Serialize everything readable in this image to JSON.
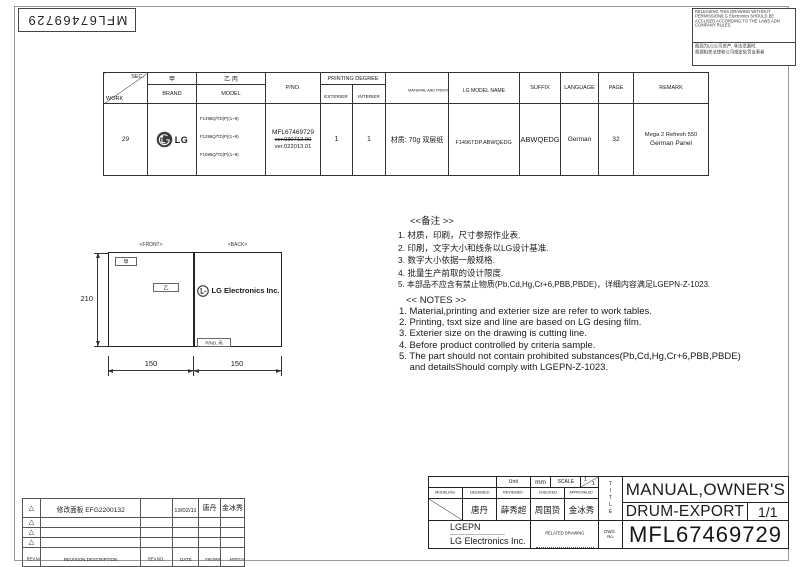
{
  "frame": {
    "code_label": "MFL67469729"
  },
  "notice": {
    "en": "RELEASING THIS DRAWING WITHOUT PERMISSION(LG Electronics SHOULD BE ACCUSED ACCORDING TO THE LAWS ADN COMPANY RULES.",
    "cn1": "图面为LG公司资产, 非法泄漏时,",
    "cn2": "根据相关法律和公司规定处罚当事者"
  },
  "work_table": {
    "h_sec": "SEC.",
    "h_work": "WORK",
    "h_jia": "甲",
    "h_brand": "BRAND",
    "h_yibing": "乙 丙",
    "h_model": "MODEL",
    "h_pno": "P/NO.",
    "h_printing_degree": "PRINTING DEGREE",
    "h_exterier": "EXTERIER",
    "h_interier": "INTERIER",
    "h_material": "MATERIAL AND PRINTING DESCRIPTION",
    "h_lg_model": "LG MODEL NAME",
    "h_suffix": "SUFFIX",
    "h_language": "LANGUAGE",
    "h_page": "PAGE",
    "h_remark": "REMARK",
    "work": "29",
    "brand": "LG",
    "models": [
      "F1496Q/TD(P)(1~9)",
      "F1296Q/TD(P)(1~9)",
      "F1096Q/TD(P)(1~9)"
    ],
    "pno": "MFL67469729",
    "ver_old": "ver.030712.00",
    "ver_new": "ver.022013.01",
    "exterier": "1",
    "interier": "1",
    "material": "材质: 70g 双层纸",
    "lg_model": "F1496TDP.ABWQEDG",
    "suffix": "ABWQEDG",
    "language": "German",
    "page": "32",
    "remark_line1": "Mega 2 Refresh 550",
    "remark_line2": "German Panel"
  },
  "drawing": {
    "front_label": "<FRONT>",
    "back_label": "<BACK>",
    "jia": "甲",
    "yi": "乙",
    "logo_text": "LG Electronics Inc.",
    "pno_box": "P/NO. 丙",
    "dim_height": "210",
    "dim_front": "150",
    "dim_back": "150"
  },
  "notes_cn": {
    "title": "<<备注 >>",
    "items": [
      "1.  材质，印刷，尺寸参照作业表.",
      "2.  印刷，文字大小和线条以LG设计基准.",
      "3.  数字大小依据一般规格.",
      "4.  批量生产前取的设计限度.",
      "5.  本部品不应含有禁止物质(Pb,Cd,Hg,Cr+6,PBB,PBDE)，详细内容满足LGEPN-Z-1023."
    ]
  },
  "notes_en": {
    "title": "<< NOTES >>",
    "items": [
      "1. Material,printing and exterier size are refer to work tables.",
      "2. Printing, tsxt  size and line are based on LG desing film.",
      "3. Exterier size on the drawing is cutting line.",
      "4. Before product controlled by criteria sample.",
      "5. The part should not contain prohibited substances(Pb,Cd,Hg,Cr+6,PBB,PBDE)",
      "    and detailsShould comply with LGEPN-Z-1023."
    ]
  },
  "title_block": {
    "unit_label": "Unit",
    "unit_value": "mm",
    "scale_label": "SCALE",
    "scale_num": "1",
    "scale_den": "1",
    "modeling": "MODELING",
    "designed": "DESIGNED",
    "reviewed": "REVIEWED",
    "checked": "CHECKED",
    "approvaled": "APPROVALED",
    "designed_name": "唐丹",
    "reviewed_name": "薛秀超",
    "checked_name": "周国贽",
    "approvaled_name": "金冰秀",
    "company_short": "LGEPN",
    "company": "LG Electronics Inc.",
    "related_drawing": "RELATED DRAWING",
    "title_vertical": "TITLE",
    "dwg_line1": "DWG.",
    "dwg_line2": "No.",
    "title_line1": "MANUAL,OWNER'S",
    "title_line2": "DRUM-EXPORT",
    "sheet": "1/1",
    "drawing_no": "MFL67469729"
  },
  "revision": {
    "h_rev_no": "REV.No.",
    "h_desc": "REVISION DESCRIPTION",
    "h_rev_no2": "REV.NO.",
    "h_date": "DATE",
    "h_prepared": "PREPARED",
    "h_approvaled": "APPROVALED",
    "marker": "△",
    "rows": [
      {
        "desc": "修改面板  EFG2200132",
        "rev": "",
        "date": "13/02/11",
        "prepared": "唐丹",
        "approvaled": "金冰秀"
      },
      {
        "desc": "",
        "rev": "",
        "date": "",
        "prepared": "",
        "approvaled": ""
      },
      {
        "desc": "",
        "rev": "",
        "date": "",
        "prepared": "",
        "approvaled": ""
      },
      {
        "desc": "",
        "rev": "",
        "date": "",
        "prepared": "",
        "approvaled": ""
      }
    ]
  }
}
